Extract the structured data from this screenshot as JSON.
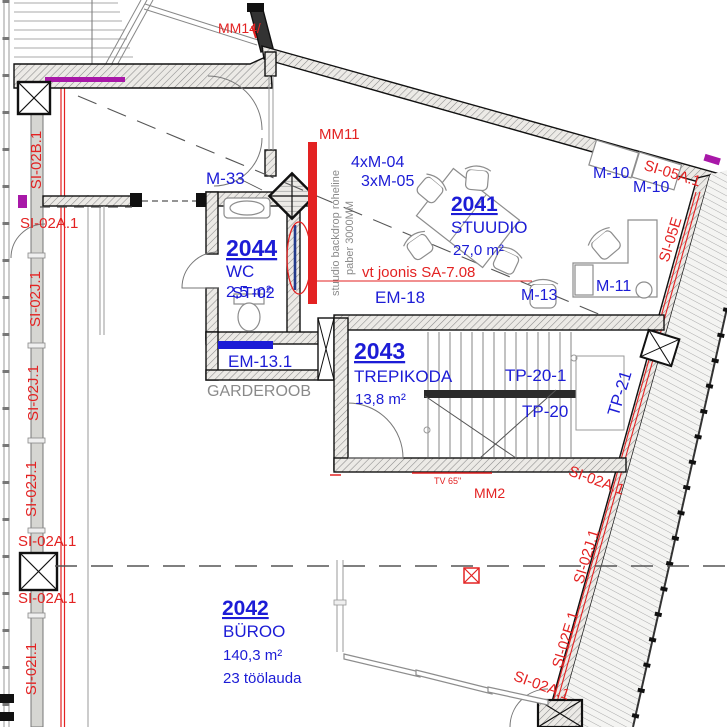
{
  "palette": {
    "annotation_red": "#e32222",
    "annotation_blue": "#1c1cd6",
    "note_gray": "#8a8a8a",
    "membrane_magenta": "#a818a8",
    "backdrop_navy": "#223a8c"
  },
  "rooms": [
    {
      "number": "2041",
      "name": "STUUDIO",
      "area": "27,0 m²"
    },
    {
      "number": "2042",
      "name": "BÜROO",
      "area": "140,3 m²",
      "workplaces": "23 töölauda"
    },
    {
      "number": "2043",
      "name": "TREPIKODA",
      "area": "13,8 m²"
    },
    {
      "number": "2044",
      "name": "WC",
      "area": "2,5 m²"
    }
  ],
  "equipment_tags": {
    "m33": "M-33",
    "m10": "M-10",
    "m11": "M-11",
    "m13": "M-13",
    "m04": "4xM-04",
    "m05": "3xM-05",
    "em18": "EM-18",
    "em13_1": "EM-13.1",
    "st02": "ST-02",
    "tp20": "TP-20",
    "tp20_1": "TP-20-1",
    "tp21": "TP-21"
  },
  "wall_tags": {
    "si02a1": "SI-02A.1",
    "si02b1": "SI-02B.1",
    "si02j1": "SI-02J.1",
    "si02i1": "SI-02I.1",
    "si02e1": "SI-02E.1",
    "si05a1": "SI-05A.1",
    "si05e": "SI-05E"
  },
  "marker_tags": {
    "mm14": "MM14/",
    "mm11": "MM11",
    "mm2": "MM2",
    "tv": "TV 65\""
  },
  "notes": {
    "backdrop_line1": "stuudio backdrop roheline",
    "backdrop_line2": "paber 3000MM",
    "see_drawing": "vt joonis SA-7.08",
    "cloakroom": "GARDEROOB"
  }
}
